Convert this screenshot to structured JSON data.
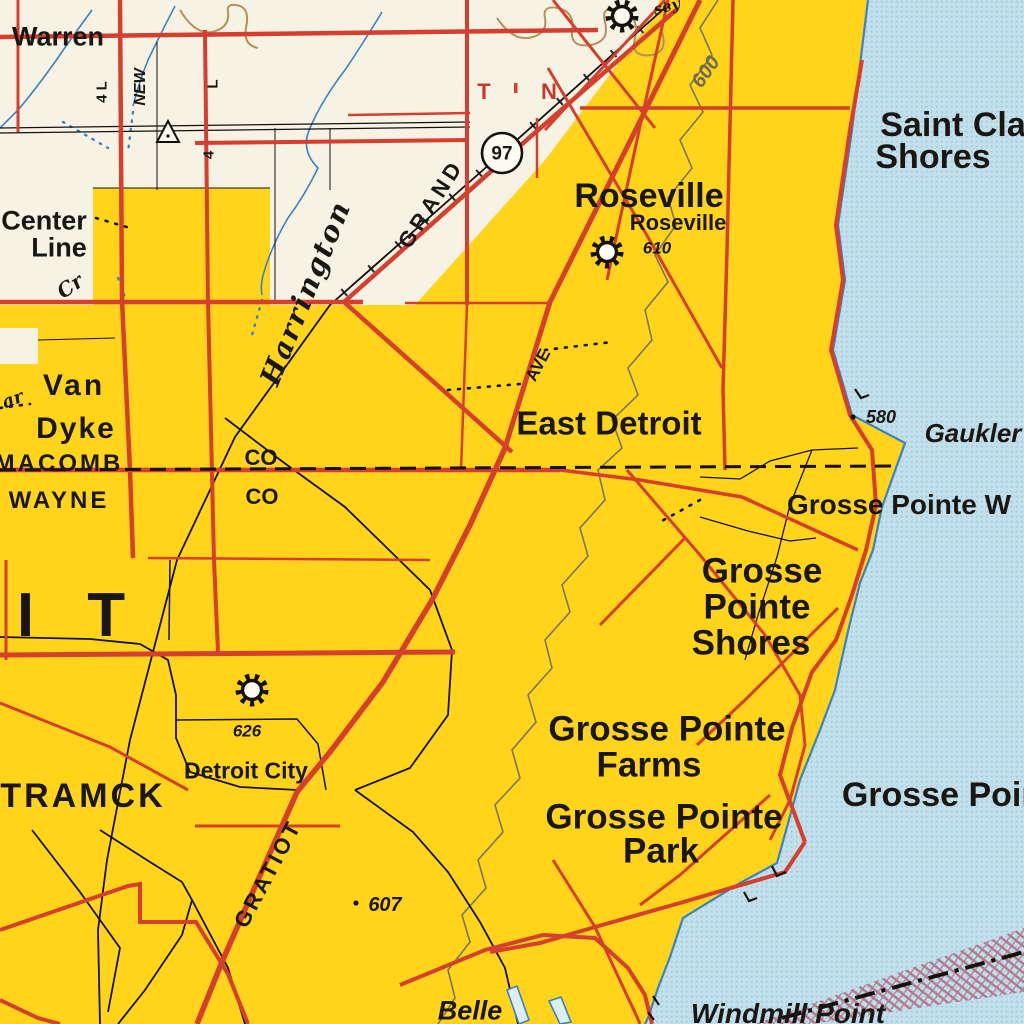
{
  "map": {
    "kind": "vintage topographic road map",
    "area": "Detroit / Lake St. Clair shoreline",
    "colors": {
      "urban_tint": "#FFD41A",
      "background_cream": "#F6F3E4",
      "water_blue": "#C2E0EC",
      "road_red": "#D63E2E",
      "contour_brown": "#7C7460",
      "stream_blue": "#3B82C4",
      "boundary_hatch_pink": "#B2556B"
    },
    "icons": {
      "gear": "gear-icon (municipal facility symbol)",
      "survey_triangle": "triangle-icon (survey marker)",
      "route_shield": "circle route shield"
    },
    "labels": {
      "warren": "Warren",
      "four_l": "4 L",
      "new_road": "NEW",
      "l_mark": "L",
      "four_mark": "4",
      "center_line_1": "Center",
      "center_line_2": "Line",
      "cr": "Cr",
      "t_mark": "T",
      "n_mark": "N",
      "route_97": "97",
      "grand": "GRAND",
      "harrington": "Harrington",
      "elev_600": "600",
      "sey": "sey",
      "roseville": "Roseville",
      "roseville_small": "Roseville",
      "elev_610": "610",
      "saint_clair_1": "Saint Cla",
      "saint_clair_2": "Shores",
      "ar": "ar",
      "van": "Van",
      "dyke": "Dyke",
      "macomb": "MACOMB",
      "wayne": "WAYNE",
      "co_upper": "CO",
      "co_lower": "CO",
      "ave": "AVE",
      "east_detroit": "East Detroit",
      "elev_580": "580",
      "gaukler": "Gaukler",
      "grosse_pointe_w": "Grosse Pointe W",
      "grosse_1": "Grosse",
      "pointe_1": "Pointe",
      "shores_1": "Shores",
      "grosse_pointe_farms_1": "Grosse Pointe",
      "grosse_pointe_farms_2": "Farms",
      "grosse_pointe_park_1": "Grosse Pointe",
      "grosse_pointe_park_2": "Park",
      "grosse_pointe_water": "Grosse Poin",
      "detroit_city": "Detroit City",
      "elev_626": "626",
      "tramck": "TRAMCK",
      "detroit_big": "I T",
      "gratiot": "GRATIOT",
      "elev_607": "607",
      "belle": "Belle",
      "windmill_point": "Windmill Point"
    }
  }
}
